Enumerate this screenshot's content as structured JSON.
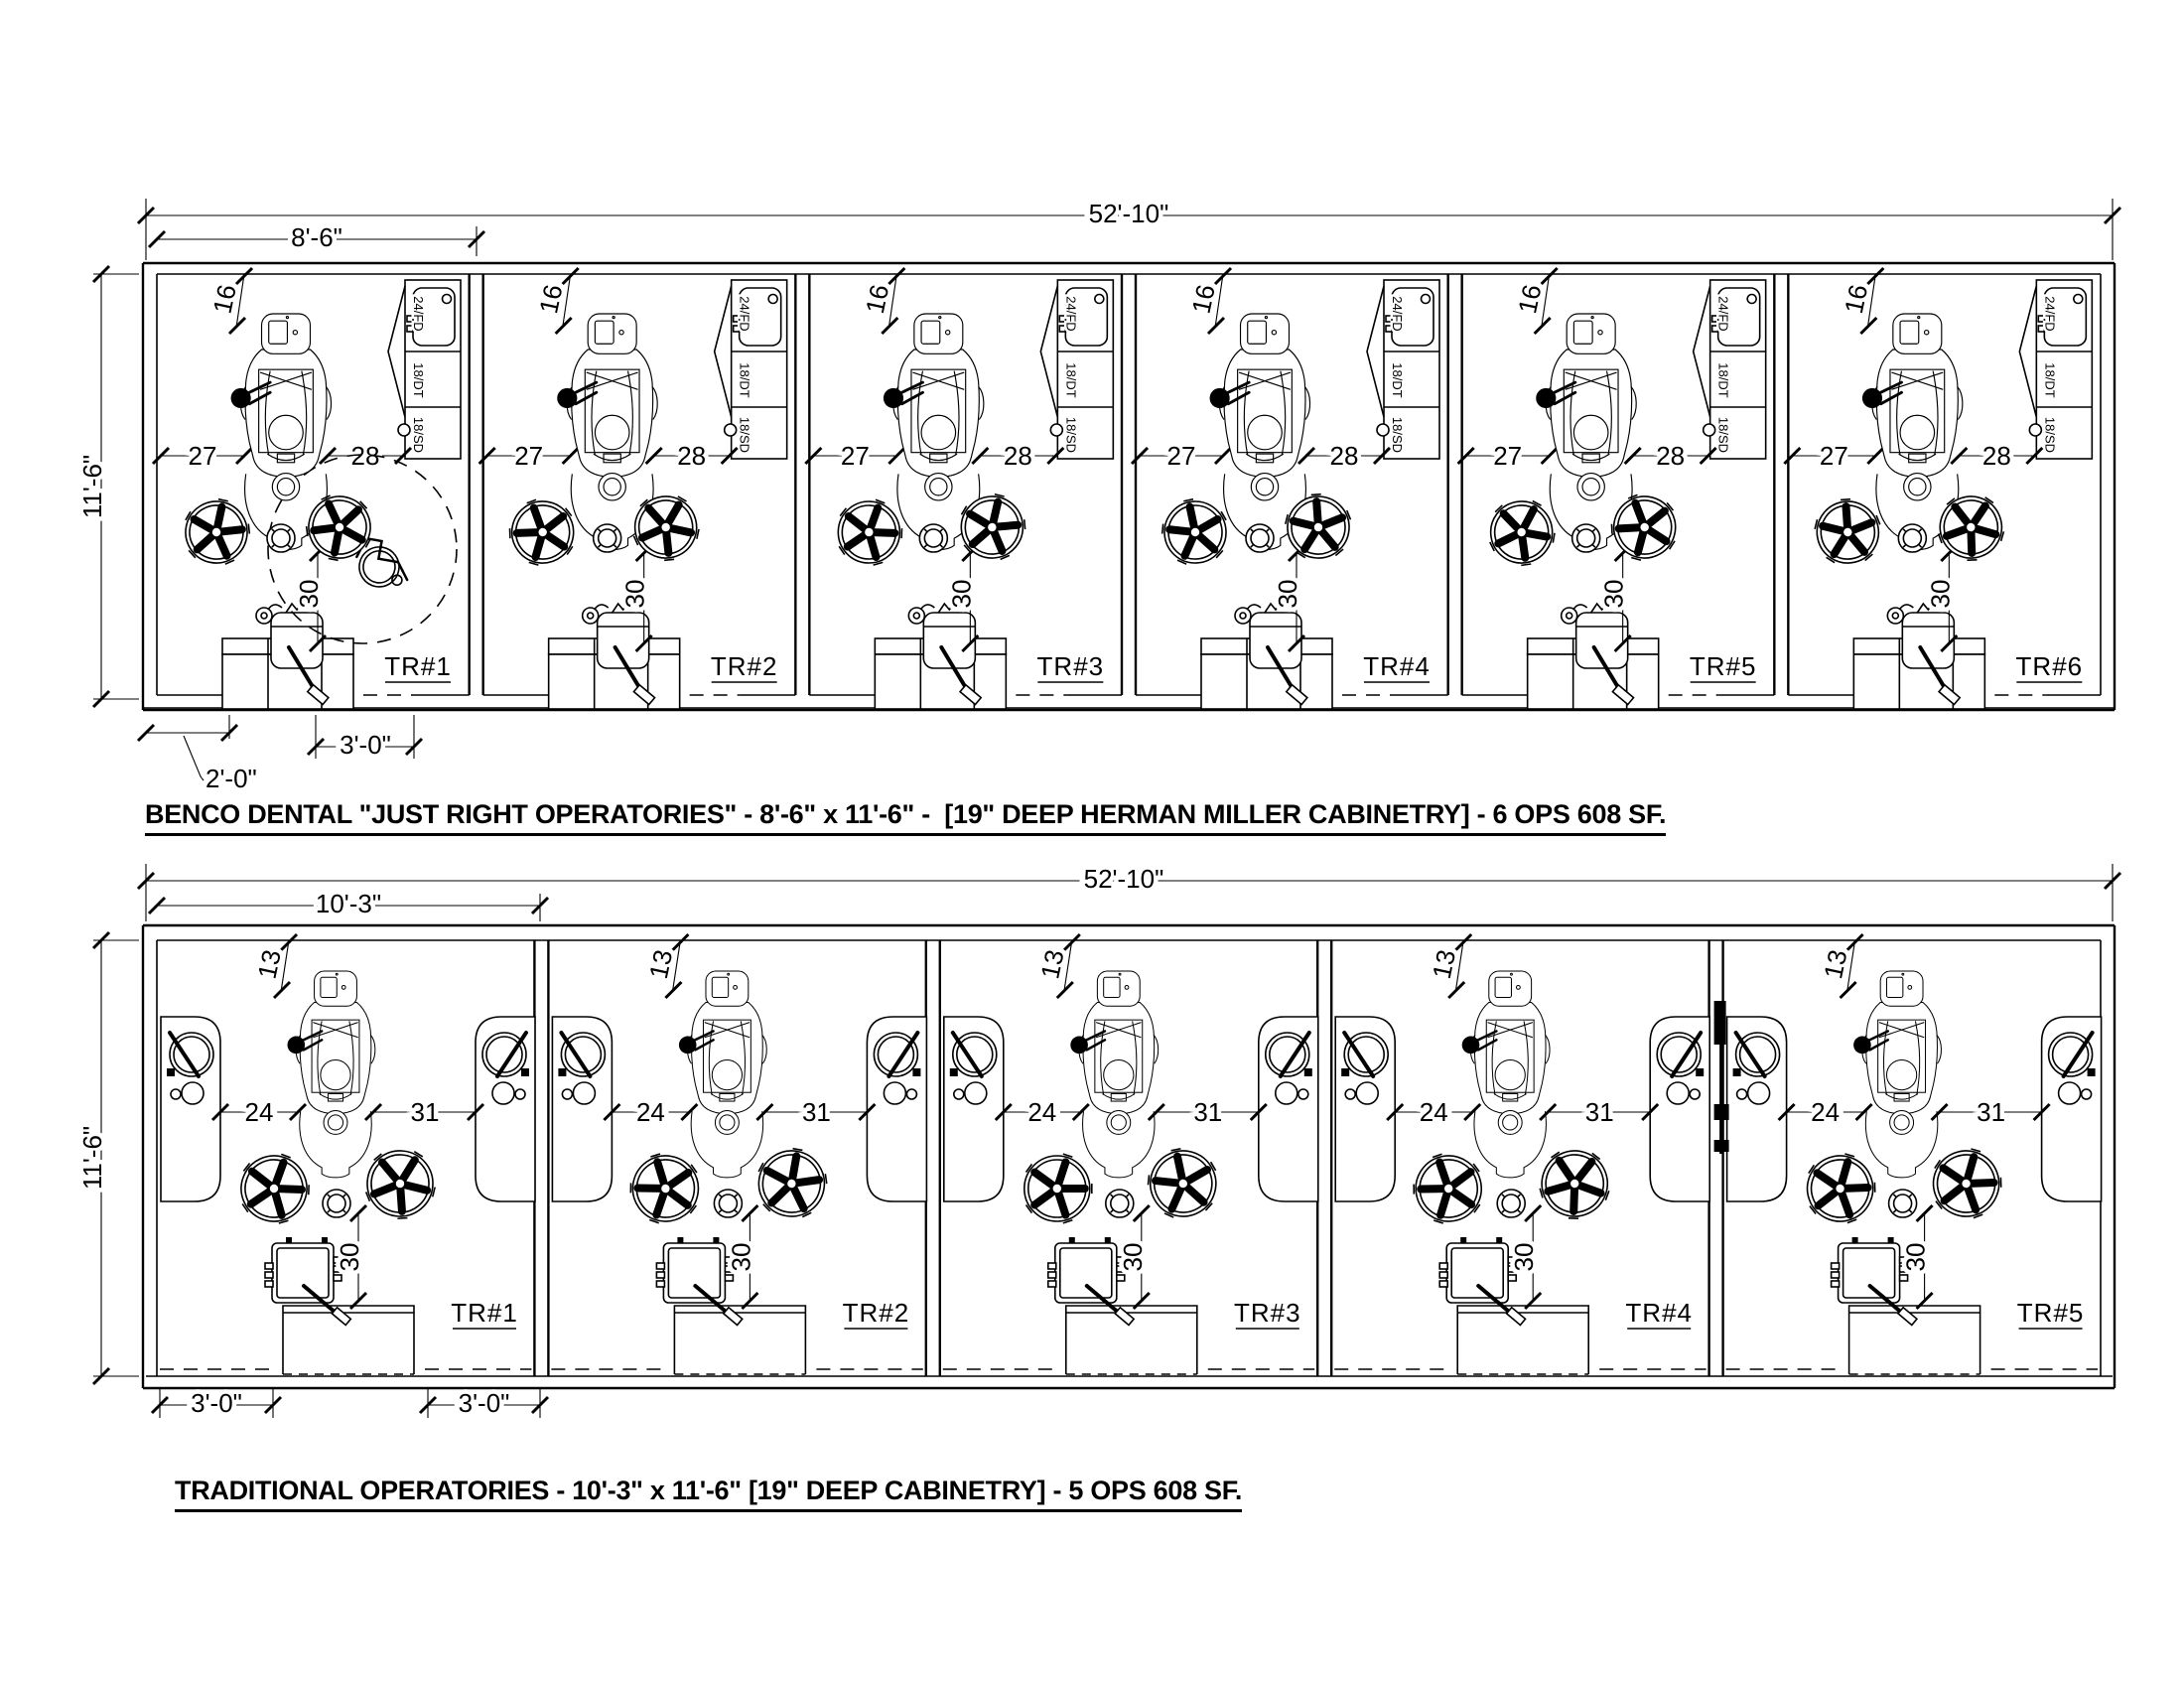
{
  "sheet": {
    "background": "#ffffff",
    "line_color": "#000000"
  },
  "plans": [
    {
      "name": "benco-just-right-operatories",
      "caption": "BENCO DENTAL \"JUST RIGHT OPERATORIES\" - 8'-6\" x 11'-6\" -  [19\" DEEP HERMAN MILLER CABINETRY] - 6 OPS 608 SF.",
      "overall_width": "52'-10\"",
      "bay_width": "8'-6\"",
      "room_depth": "11'-6\"",
      "rooms": [
        "TR#1",
        "TR#2",
        "TR#3",
        "TR#4",
        "TR#5",
        "TR#6"
      ],
      "dims": {
        "head_clearance": "16",
        "left_of_chair": "27",
        "right_of_chair": "28",
        "chair_to_rear": "30"
      },
      "door_dims": [
        "2'-0\"",
        "3'-0\""
      ],
      "cabinet_labels": [
        "24/FD",
        "18/DT",
        "18/SD"
      ]
    },
    {
      "name": "traditional-operatories",
      "caption": "TRADITIONAL OPERATORIES - 10'-3\" x 11'-6\" [19\" DEEP CABINETRY] - 5 OPS 608 SF.",
      "overall_width": "52'-10\"",
      "bay_width": "10'-3\"",
      "room_depth": "11'-6\"",
      "rooms": [
        "TR#1",
        "TR#2",
        "TR#3",
        "TR#4",
        "TR#5"
      ],
      "dims": {
        "head_clearance": "13",
        "left_of_chair": "24",
        "right_of_chair": "31",
        "chair_to_rear": "30"
      },
      "door_dims": [
        "3'-0\"",
        "3'-0\""
      ],
      "cabinet_labels": []
    }
  ]
}
